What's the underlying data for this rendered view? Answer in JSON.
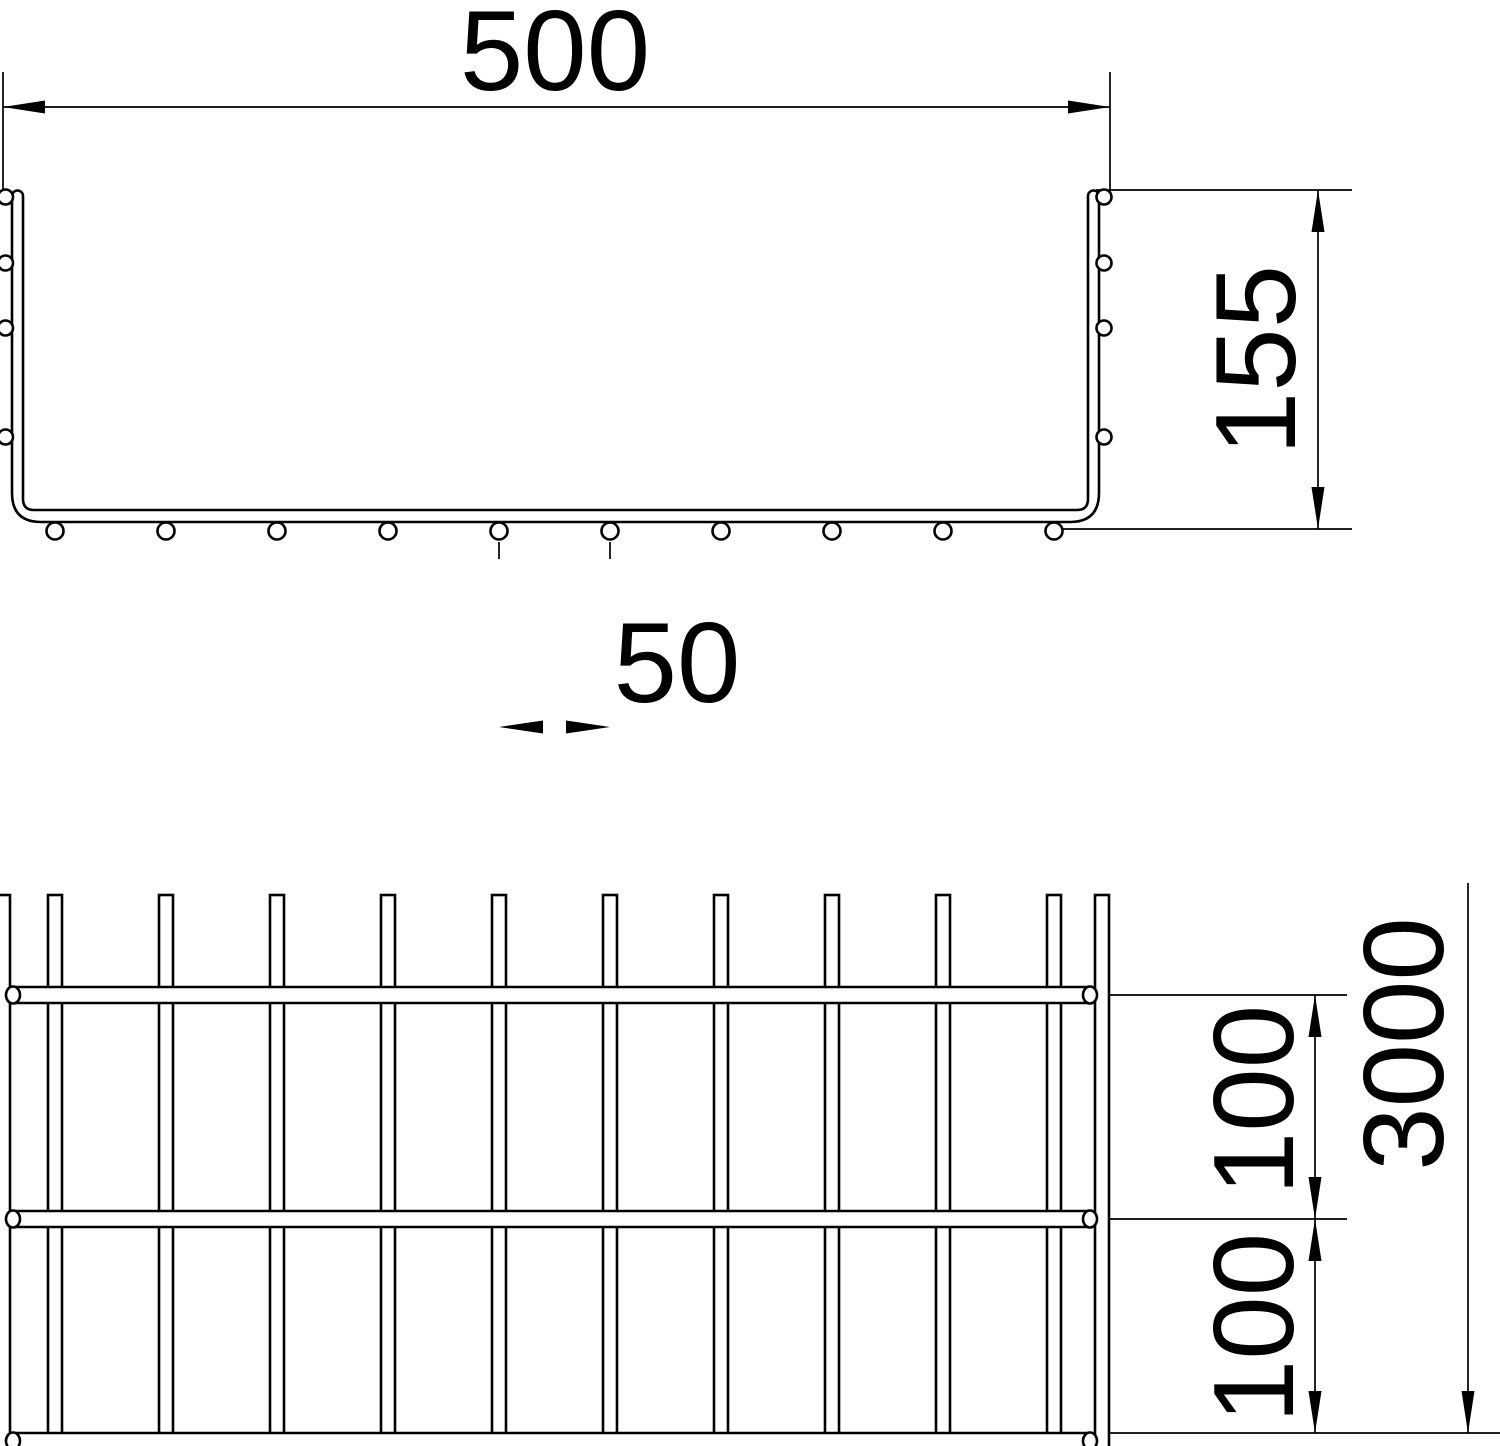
{
  "drawing": {
    "background": "#ffffff",
    "line_color": "#000000",
    "cross_section": {
      "width_mm": "500",
      "height_mm": "155",
      "wire_spacing_mm": "50"
    },
    "plan_view": {
      "rung_spacing_1_mm": "100",
      "rung_spacing_2_mm": "100",
      "length_mm": "3000"
    }
  }
}
